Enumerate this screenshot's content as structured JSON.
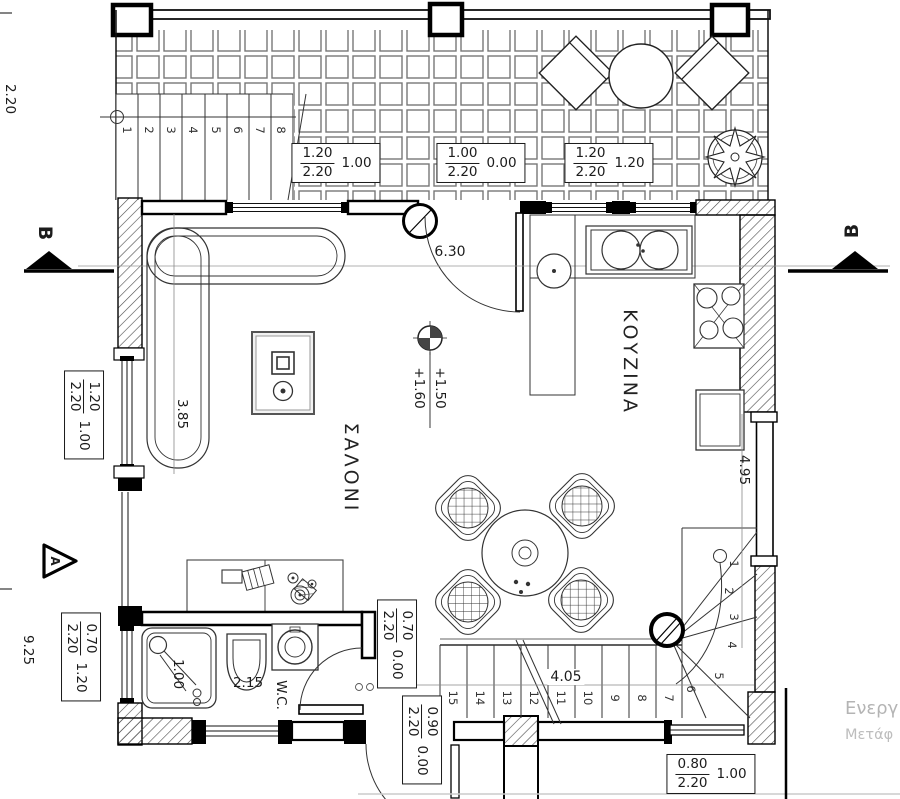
{
  "rooms": {
    "living": "ΣΑΛΟΝΙ",
    "kitchen": "ΚΟΥΖΙΝΑ",
    "wc": "W.C."
  },
  "levels": {
    "upper": "+1.50",
    "lower": "+1.60"
  },
  "dims": {
    "terrace_h": "2.20",
    "left_h": "9.25",
    "entry": "6.30",
    "living": "3.85",
    "kitchen_wall": "4.95",
    "stair_run": "4.05",
    "wc": "2.15",
    "shower": "1.00"
  },
  "sched": {
    "t1": {
      "num": "1.20",
      "den": "2.20",
      "val": "1.00"
    },
    "t2": {
      "num": "1.00",
      "den": "2.20",
      "val": "0.00"
    },
    "t3": {
      "num": "1.20",
      "den": "2.20",
      "val": "1.20"
    },
    "lw": {
      "num": "1.20",
      "den": "2.20",
      "val": "1.00"
    },
    "wcw": {
      "num": "0.70",
      "den": "2.20",
      "val": "1.20"
    },
    "wcd": {
      "num": "0.70",
      "den": "2.20",
      "val": "0.00"
    },
    "ed": {
      "num": "0.90",
      "den": "2.20",
      "val": "0.00"
    },
    "brw": {
      "num": "0.80",
      "den": "2.20",
      "val": "1.00"
    }
  },
  "sections": {
    "left": "B",
    "right": "B",
    "a": "A"
  },
  "stairs": {
    "top": [
      "1",
      "2",
      "3",
      "4",
      "5",
      "6",
      "7",
      "8"
    ],
    "main": [
      "15",
      "14",
      "13",
      "12",
      "11",
      "10",
      "9",
      "8",
      "7",
      "6",
      "5",
      "4",
      "3",
      "2",
      "1"
    ]
  },
  "watermark": {
    "line1": "Ενεργ",
    "line2": "Μετάφ"
  }
}
